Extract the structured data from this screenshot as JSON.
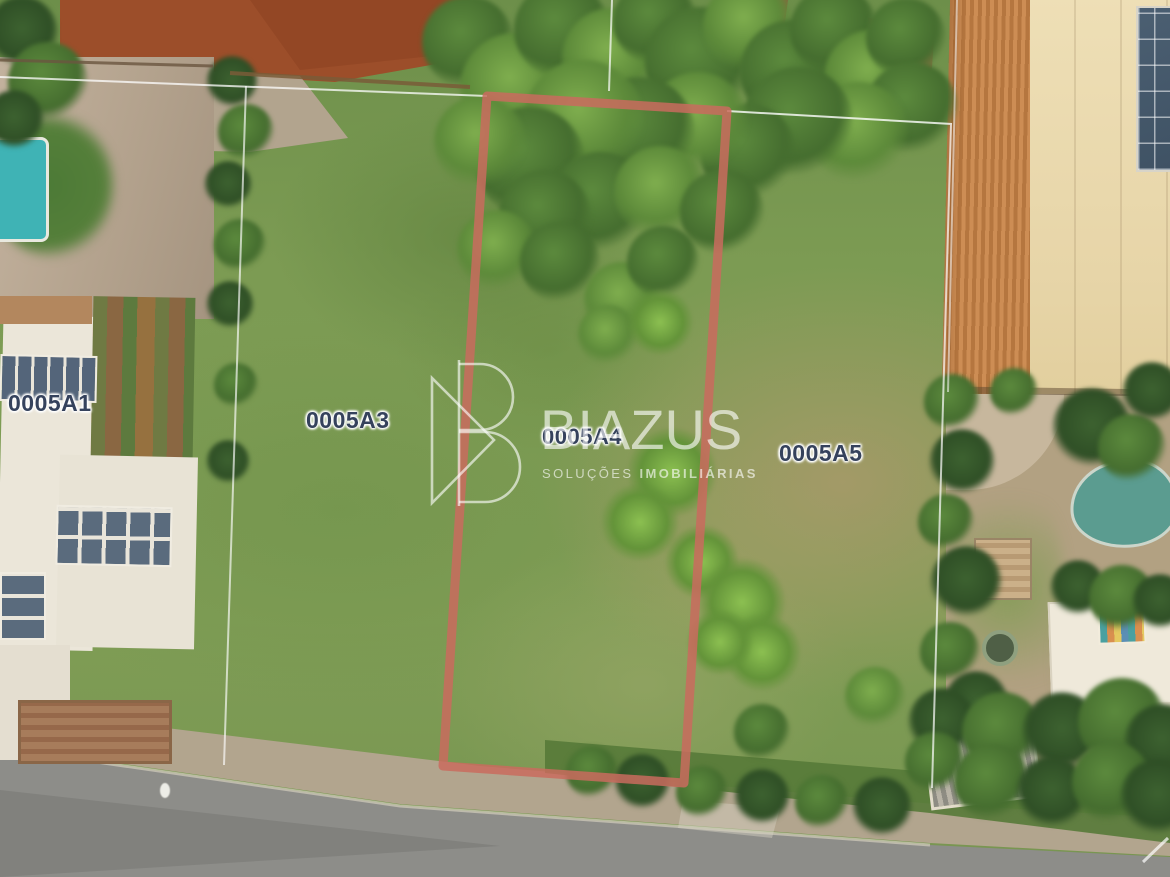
{
  "scene": {
    "description": "Aerial drone view of residential land parcels with one lot outlined for sale",
    "watermark": {
      "brand": "BIAZUS",
      "tagline_light": "SOLUÇÕES",
      "tagline_bold": "IMOBILIÁRIAS"
    },
    "parcels": [
      {
        "label": "0005A1",
        "highlighted": false
      },
      {
        "label": "0005A3",
        "highlighted": false
      },
      {
        "label": "0005A4",
        "highlighted": true
      },
      {
        "label": "0005A5",
        "highlighted": false
      }
    ],
    "colors": {
      "parcel_outline": "#C96B5E",
      "parcel_label_text": "#35425C",
      "label_halo": "#FFFFFF",
      "watermark_white": "#FFFFFF",
      "grass": "#7C9B53",
      "red_soil": "#9C4E2A",
      "road_asphalt": "#8D8D89",
      "tiled_roof": "#C0803F",
      "left_pool": "#3FB3B5",
      "right_pool": "#5B9C90"
    }
  }
}
